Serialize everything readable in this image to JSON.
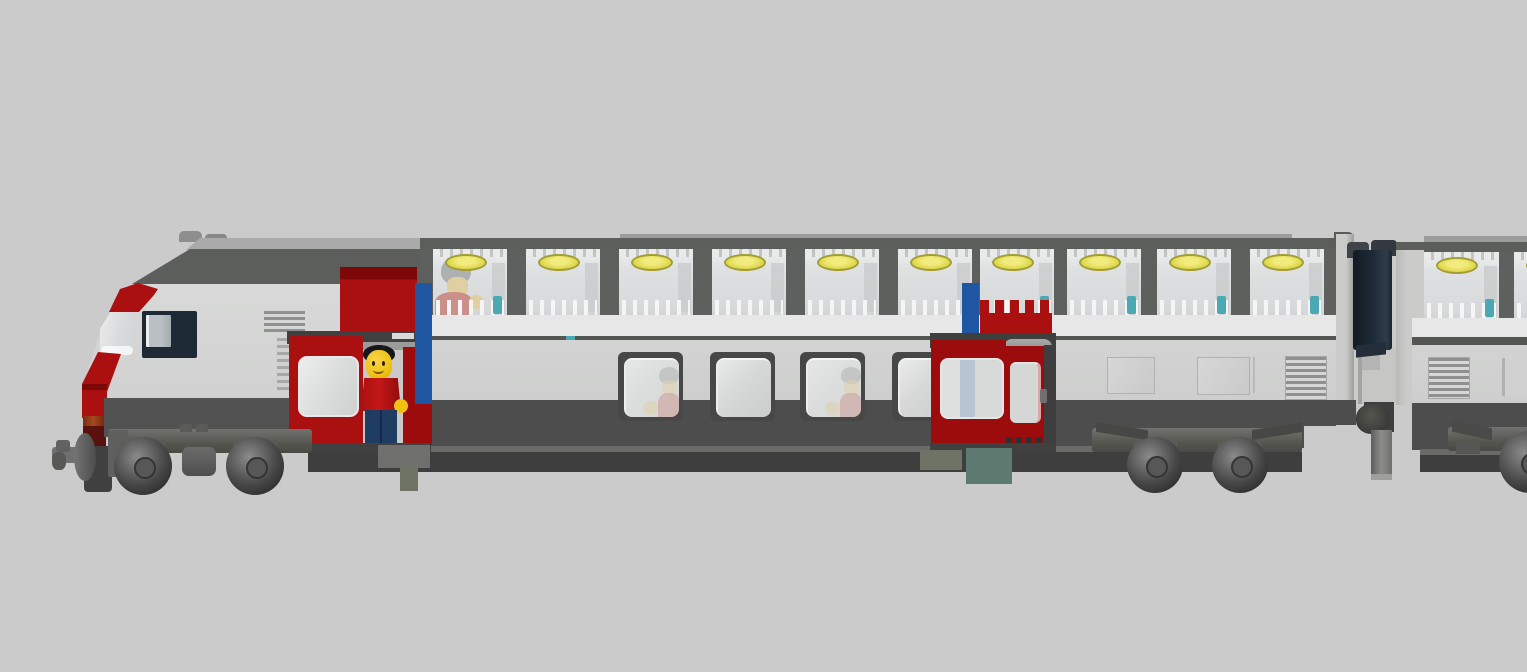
{
  "app": {
    "type": "3d-model-render",
    "subject": "LEGO double-deck intercity train, side view",
    "background": "#cacbca"
  },
  "colors": {
    "background": "#cacbca",
    "body_light": "#d4d5d4",
    "body_lower": "#cdcecd",
    "floor_band": "#e6e7e6",
    "roof_top_strip": "#9b9c9b",
    "roof_dark": "#5c5e5c",
    "cab_roof_light": "#a9aaa9",
    "pillar_gray": "#5e605e",
    "deck_line": "#545654",
    "dark_band": "#4c4d4c",
    "under_seam": "#6a6b68",
    "under_strip": "#3d3e3d",
    "window_frame_dark": "#464746",
    "lower_glass": "#d7d8d8",
    "upper_glass": "#d9dbdc",
    "upper_glass_hi": "#eef0f0",
    "glass_seam": "#bcbdbe",
    "stud_light": "#e8e9e9",
    "stud_dark": "#b2b3b2",
    "lamp_yellow": "#e3dc55",
    "lamp_rim": "#a39d33",
    "baluster_white": "#f4f5f4",
    "teal": "#4aa9b2",
    "red_bright": "#ab1010",
    "red_mid": "#9c0c0c",
    "red_deep": "#7c0808",
    "red_maroon": "#5a100c",
    "orange_light": "#a24a1e",
    "blue_stripe": "#1e56a2",
    "blue_dot": "#3a62c8",
    "navy_window": "#1d2935",
    "navy_bellows": "#1b2531",
    "silver": "#d8d9d8",
    "panel_outline": "#b0b1b0",
    "vent_stripe": "#8f908f",
    "skirt_gray": "#515251",
    "bogie_frame": "#676866",
    "bogie_dark": "#3f403f",
    "axlebox": "#5b5c5a",
    "tire_dark": "#303130",
    "wheel_mid": "#646564",
    "wheel_hi": "#8a8b8a",
    "hub": "#565756",
    "coupler_gray": "#6f706f",
    "underbody_green": "#6e7366",
    "underbody_teal": "#5d7a70",
    "gang_plate": "#c6c7c5",
    "post_gray": "#8d8e8b",
    "minifig_yellow": "#f0c015",
    "minifig_red": "#bf1515",
    "minifig_legs": "#1f3c63",
    "hair_black": "#15181a",
    "hair_gray": "#8e9193",
    "faded_face": "#dcc283",
    "faded_red": "#bd6b62",
    "interior_gray": "#c8c9c8"
  },
  "scene": {
    "figures": [
      {
        "name": "conductor",
        "location": "open front door",
        "hair": "black",
        "shirt": "red",
        "legs": "dark-blue"
      },
      {
        "name": "passenger-upper-deck",
        "location": "first upper-deck window",
        "hair": "gray",
        "shirt": "red"
      },
      {
        "name": "passenger-lower-1",
        "location": "first lower-deck window",
        "hair": "gray",
        "shirt": "red"
      },
      {
        "name": "passenger-lower-2",
        "location": "third lower-deck window",
        "hair": "gray",
        "shirt": "red"
      }
    ]
  },
  "train": {
    "car1": {
      "upper_windows": {
        "xs": [
          433,
          526,
          619,
          712,
          805,
          898,
          980,
          1067,
          1157,
          1250
        ],
        "y": 249,
        "width": 74,
        "height": 67,
        "passenger_index": 0,
        "teal_indices": [
          0,
          6,
          7,
          8,
          9
        ]
      },
      "lower_windows": {
        "xs": [
          618,
          710,
          800,
          892
        ],
        "y": 352,
        "width": 65,
        "height": 69,
        "passenger_indices": [
          0,
          2
        ]
      }
    },
    "car2": {
      "upper_windows": {
        "xs": [
          1424,
          1514
        ],
        "y": 252,
        "width": 75,
        "height": 67,
        "teal_indices": [
          0
        ]
      }
    },
    "bogies": [
      {
        "frame": [
          108,
          312
        ],
        "frame_y": 429,
        "wheels": [
          [
            143,
            466
          ],
          [
            255,
            466
          ]
        ],
        "radius": 29,
        "center_detail": true,
        "plate": true
      },
      {
        "frame": [
          1092,
          1302
        ],
        "frame_y": 428,
        "wheels": [
          [
            1155,
            465
          ],
          [
            1240,
            465
          ]
        ],
        "radius": 28,
        "arms": true
      },
      {
        "frame": [
          1448,
          1530
        ],
        "frame_y": 427,
        "wheels": [
          [
            1530,
            462
          ]
        ],
        "radius": 31,
        "arm_single": true
      }
    ]
  }
}
